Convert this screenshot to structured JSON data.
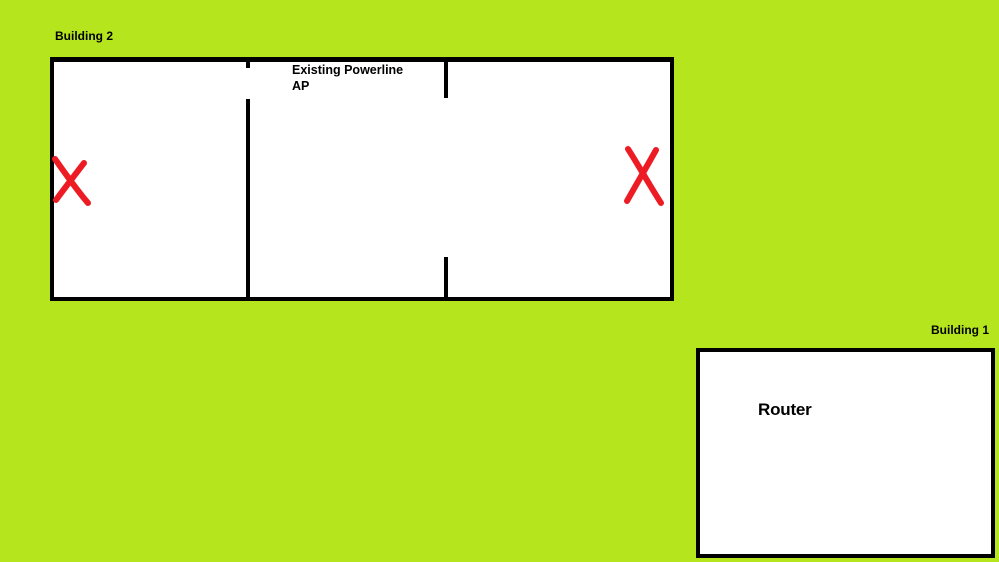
{
  "colors": {
    "background": "#b5e61d",
    "wall": "#000000",
    "room_fill": "#ffffff",
    "x_mark": "#ed1c24",
    "text": "#000000"
  },
  "building2": {
    "label": "Building 2",
    "ap_annotation": {
      "line1": "Existing Powerline",
      "line2": "AP"
    },
    "markers": [
      {
        "name": "dead-zone-x-left",
        "symbol": "X"
      },
      {
        "name": "dead-zone-x-right",
        "symbol": "X"
      }
    ]
  },
  "building1": {
    "label": "Building 1",
    "room_label": "Router"
  }
}
